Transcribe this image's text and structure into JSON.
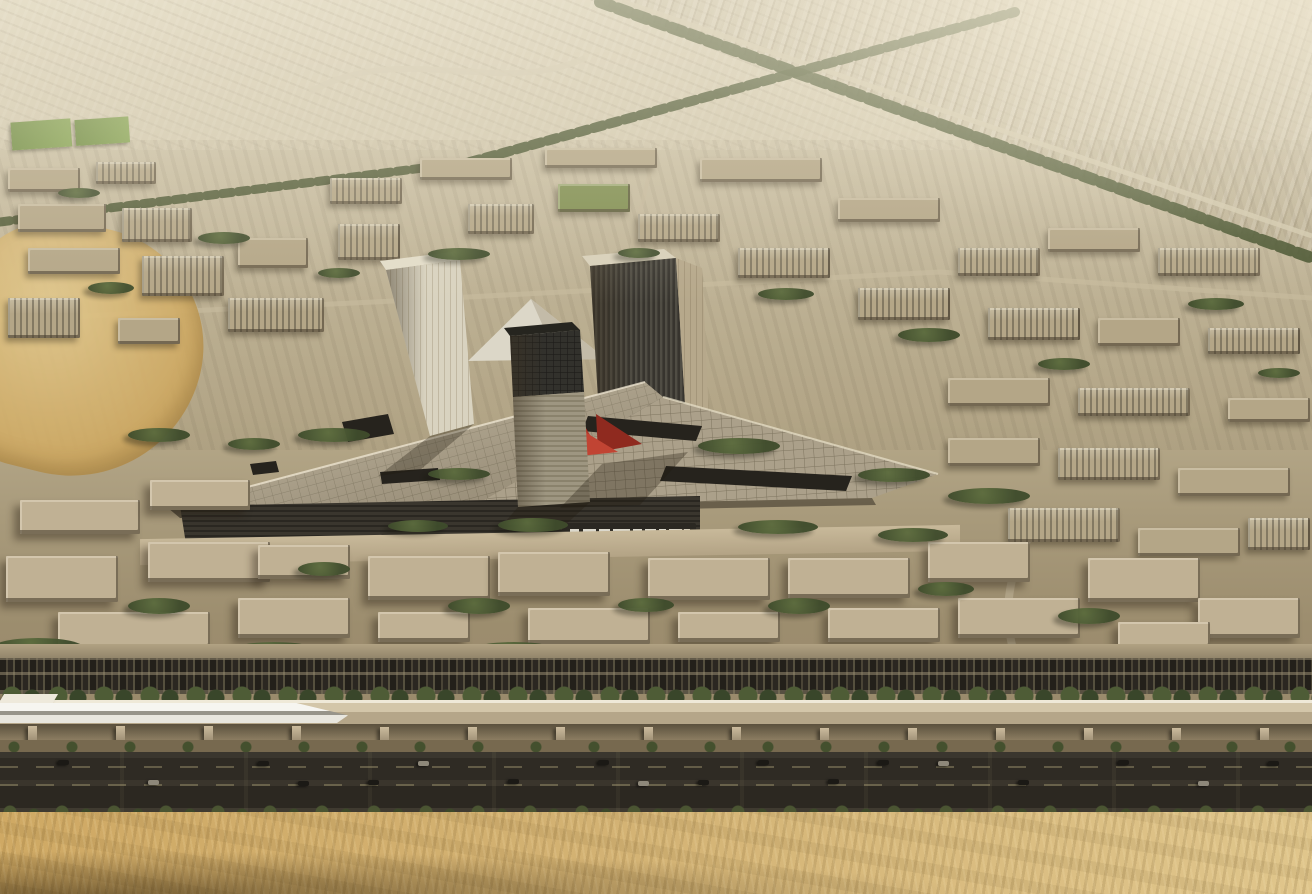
{
  "scene": {
    "title": "Aerial architectural rendering of a desert masterplan development",
    "description": "Bird's-eye rendering: hazy low-rise city grid in desert tones; central mixed-use complex with two tall towers, one mid tower, a white pyramid roof, a triangular gridded canopy with roof cutouts and a red sculptural accent; foreground campus blocks with dense trees; parking strip full of cars; elevated guideway with a white high-speed train; dark multi-lane highway; golden sand dunes across the bottom edge",
    "sign": {
      "text_legible": false,
      "description": "small white logo lettering on dark podium band, illegible at this resolution"
    },
    "elements": [
      "distant-suburb-rooftops",
      "tree-lined-avenues",
      "sports-field",
      "desert-patch",
      "midrise-district",
      "central-complex",
      "left-tower",
      "right-tower",
      "middle-tower",
      "pyramid-roof",
      "triangular-canopy",
      "roof-cutouts",
      "red-sculpture",
      "podium-sign",
      "campus-buildings",
      "tree-clusters",
      "parking-strip",
      "hedge-row",
      "elevated-guideway",
      "high-speed-train",
      "guideway-columns",
      "highway",
      "cars",
      "shrub-row",
      "sand-desert"
    ],
    "colors": {
      "sky_top": "#dcd3bb",
      "sky_mid": "#c3b79a",
      "city_tan": "#b4a687",
      "campus_tan": "#c0b194",
      "green_roof": "#7f8e50",
      "tree_green": "#3f4c2c",
      "avenue_green": "#46522e",
      "field_green": "#6f8c42",
      "canopy": "#b7ab93",
      "canopy_right": "#aba08a",
      "canopy_line": "#8a8069",
      "podium": "#3a362e",
      "sign_dark": "#2b2822",
      "tower_light": "#d9d3c0",
      "tower_dark": "#46433b",
      "tower_lit": "#b6a88b",
      "pyramid": "#dcd7c8",
      "mid_tower_top": "#32312c",
      "mid_tower_base": "#9e9681",
      "red_accent": "#b23527",
      "red_deep": "#8f2a1f",
      "train_white": "#f6f5f0",
      "deck": "#d3c6a9",
      "column": "#cbbb9d",
      "parking": "#57503f",
      "highway": "#2f2b24",
      "road_light": "#c6b99c",
      "sand_light": "#e0c68c",
      "sand_gold": "#cfa964",
      "sand_shadow": "#3c2c10"
    },
    "city_blocks": [
      [
        8,
        168,
        72,
        24,
        ""
      ],
      [
        96,
        162,
        60,
        22,
        "win"
      ],
      [
        18,
        204,
        88,
        28,
        ""
      ],
      [
        122,
        208,
        70,
        34,
        "win"
      ],
      [
        28,
        248,
        92,
        26,
        ""
      ],
      [
        142,
        256,
        82,
        40,
        "win"
      ],
      [
        238,
        238,
        70,
        30,
        ""
      ],
      [
        8,
        298,
        72,
        40,
        "win"
      ],
      [
        228,
        298,
        96,
        34,
        "win"
      ],
      [
        118,
        318,
        62,
        26,
        ""
      ],
      [
        330,
        178,
        72,
        26,
        "win"
      ],
      [
        420,
        158,
        92,
        22,
        ""
      ],
      [
        338,
        224,
        62,
        36,
        "win"
      ],
      [
        468,
        204,
        66,
        30,
        "win"
      ],
      [
        545,
        148,
        112,
        20,
        ""
      ],
      [
        558,
        184,
        72,
        28,
        "grn"
      ],
      [
        638,
        214,
        82,
        28,
        "win"
      ],
      [
        700,
        158,
        122,
        24,
        ""
      ],
      [
        738,
        248,
        92,
        30,
        "win"
      ],
      [
        838,
        198,
        102,
        24,
        ""
      ],
      [
        858,
        288,
        92,
        32,
        "win"
      ],
      [
        958,
        248,
        82,
        28,
        "win"
      ],
      [
        1048,
        228,
        92,
        24,
        ""
      ],
      [
        1158,
        248,
        102,
        28,
        "win"
      ],
      [
        988,
        308,
        92,
        32,
        "win"
      ],
      [
        1098,
        318,
        82,
        28,
        ""
      ],
      [
        1208,
        328,
        92,
        26,
        "win"
      ],
      [
        948,
        378,
        102,
        28,
        ""
      ],
      [
        1078,
        388,
        112,
        28,
        "win"
      ],
      [
        1228,
        398,
        82,
        24,
        ""
      ],
      [
        948,
        438,
        92,
        28,
        ""
      ],
      [
        1058,
        448,
        102,
        32,
        "win"
      ],
      [
        1178,
        468,
        112,
        28,
        ""
      ],
      [
        1008,
        508,
        112,
        34,
        "win"
      ],
      [
        1138,
        528,
        102,
        28,
        ""
      ],
      [
        1248,
        518,
        62,
        32,
        "win"
      ]
    ],
    "campus_blocks": [
      [
        6,
        556,
        112,
        46,
        "win"
      ],
      [
        148,
        542,
        122,
        40,
        ""
      ],
      [
        58,
        612,
        152,
        36,
        "win"
      ],
      [
        238,
        598,
        112,
        40,
        ""
      ],
      [
        368,
        556,
        122,
        44,
        ""
      ],
      [
        378,
        612,
        92,
        30,
        "win"
      ],
      [
        498,
        552,
        112,
        44,
        ""
      ],
      [
        528,
        608,
        122,
        36,
        "win"
      ],
      [
        648,
        558,
        122,
        42,
        "win"
      ],
      [
        678,
        612,
        102,
        30,
        ""
      ],
      [
        788,
        558,
        122,
        40,
        ""
      ],
      [
        828,
        608,
        112,
        34,
        "win"
      ],
      [
        928,
        542,
        102,
        40,
        ""
      ],
      [
        958,
        598,
        122,
        40,
        "win"
      ],
      [
        1088,
        558,
        112,
        44,
        "win"
      ],
      [
        1198,
        598,
        102,
        40,
        ""
      ],
      [
        1118,
        622,
        92,
        26,
        ""
      ],
      [
        258,
        545,
        92,
        34,
        "win"
      ],
      [
        20,
        500,
        120,
        34,
        "win"
      ],
      [
        150,
        480,
        100,
        30,
        ""
      ]
    ],
    "tree_clusters": [
      [
        58,
        188,
        42,
        10,
        ""
      ],
      [
        198,
        232,
        52,
        12,
        ""
      ],
      [
        318,
        268,
        42,
        10,
        ""
      ],
      [
        88,
        282,
        46,
        12,
        ""
      ],
      [
        428,
        248,
        62,
        12,
        ""
      ],
      [
        618,
        248,
        42,
        10,
        ""
      ],
      [
        758,
        288,
        56,
        12,
        ""
      ],
      [
        898,
        328,
        62,
        14,
        ""
      ],
      [
        1038,
        358,
        52,
        12,
        ""
      ],
      [
        1188,
        298,
        56,
        12,
        ""
      ],
      [
        1258,
        368,
        42,
        10,
        ""
      ],
      [
        298,
        428,
        72,
        14,
        ""
      ],
      [
        698,
        438,
        82,
        16,
        ""
      ],
      [
        858,
        468,
        72,
        14,
        ""
      ],
      [
        948,
        488,
        82,
        16,
        ""
      ],
      [
        428,
        468,
        62,
        12,
        ""
      ],
      [
        228,
        438,
        52,
        12,
        ""
      ],
      [
        128,
        428,
        62,
        14,
        ""
      ],
      [
        -8,
        638,
        92,
        20,
        ""
      ],
      [
        108,
        648,
        102,
        22,
        ""
      ],
      [
        228,
        642,
        92,
        20,
        ""
      ],
      [
        338,
        648,
        112,
        22,
        ""
      ],
      [
        468,
        642,
        92,
        20,
        ""
      ],
      [
        588,
        648,
        112,
        22,
        ""
      ],
      [
        718,
        646,
        102,
        20,
        ""
      ],
      [
        838,
        648,
        112,
        22,
        ""
      ],
      [
        958,
        646,
        92,
        20,
        ""
      ],
      [
        1068,
        648,
        112,
        22,
        ""
      ],
      [
        1198,
        646,
        112,
        22,
        ""
      ],
      [
        128,
        598,
        62,
        16,
        ""
      ],
      [
        298,
        562,
        52,
        14,
        ""
      ],
      [
        448,
        598,
        62,
        16,
        ""
      ],
      [
        618,
        598,
        56,
        14,
        ""
      ],
      [
        768,
        598,
        62,
        16,
        ""
      ],
      [
        918,
        582,
        56,
        14,
        ""
      ],
      [
        1058,
        608,
        62,
        16,
        ""
      ],
      [
        498,
        518,
        70,
        14,
        ""
      ],
      [
        388,
        520,
        60,
        12,
        ""
      ],
      [
        738,
        520,
        80,
        14,
        ""
      ],
      [
        878,
        528,
        70,
        14,
        ""
      ]
    ],
    "guideway_columns": [
      [
        28,
        726,
        9,
        20,
        ""
      ],
      [
        116,
        726,
        9,
        20,
        ""
      ],
      [
        204,
        726,
        9,
        20,
        ""
      ],
      [
        292,
        726,
        9,
        20,
        ""
      ],
      [
        380,
        727,
        9,
        20,
        ""
      ],
      [
        468,
        727,
        9,
        20,
        ""
      ],
      [
        556,
        727,
        9,
        19,
        ""
      ],
      [
        644,
        727,
        9,
        19,
        ""
      ],
      [
        732,
        727,
        9,
        19,
        ""
      ],
      [
        820,
        728,
        9,
        18,
        ""
      ],
      [
        908,
        728,
        9,
        18,
        ""
      ],
      [
        996,
        728,
        9,
        18,
        ""
      ],
      [
        1084,
        728,
        9,
        18,
        ""
      ],
      [
        1172,
        728,
        9,
        18,
        ""
      ],
      [
        1260,
        728,
        9,
        18,
        ""
      ]
    ],
    "highway_cars": [
      [
        58,
        760,
        11,
        5,
        ""
      ],
      [
        148,
        780,
        11,
        5,
        "lt"
      ],
      [
        258,
        761,
        11,
        5,
        ""
      ],
      [
        298,
        781,
        11,
        5,
        ""
      ],
      [
        418,
        761,
        11,
        5,
        "lt"
      ],
      [
        508,
        779,
        11,
        5,
        ""
      ],
      [
        598,
        760,
        11,
        5,
        ""
      ],
      [
        638,
        781,
        11,
        5,
        "lt"
      ],
      [
        758,
        760,
        11,
        5,
        ""
      ],
      [
        828,
        779,
        11,
        5,
        ""
      ],
      [
        938,
        761,
        11,
        5,
        "lt"
      ],
      [
        1018,
        780,
        11,
        5,
        ""
      ],
      [
        1118,
        760,
        11,
        5,
        ""
      ],
      [
        1198,
        781,
        11,
        5,
        "lt"
      ],
      [
        1268,
        761,
        11,
        5,
        ""
      ],
      [
        368,
        780,
        11,
        5,
        ""
      ],
      [
        698,
        780,
        11,
        5,
        ""
      ],
      [
        878,
        760,
        11,
        5,
        ""
      ]
    ]
  }
}
